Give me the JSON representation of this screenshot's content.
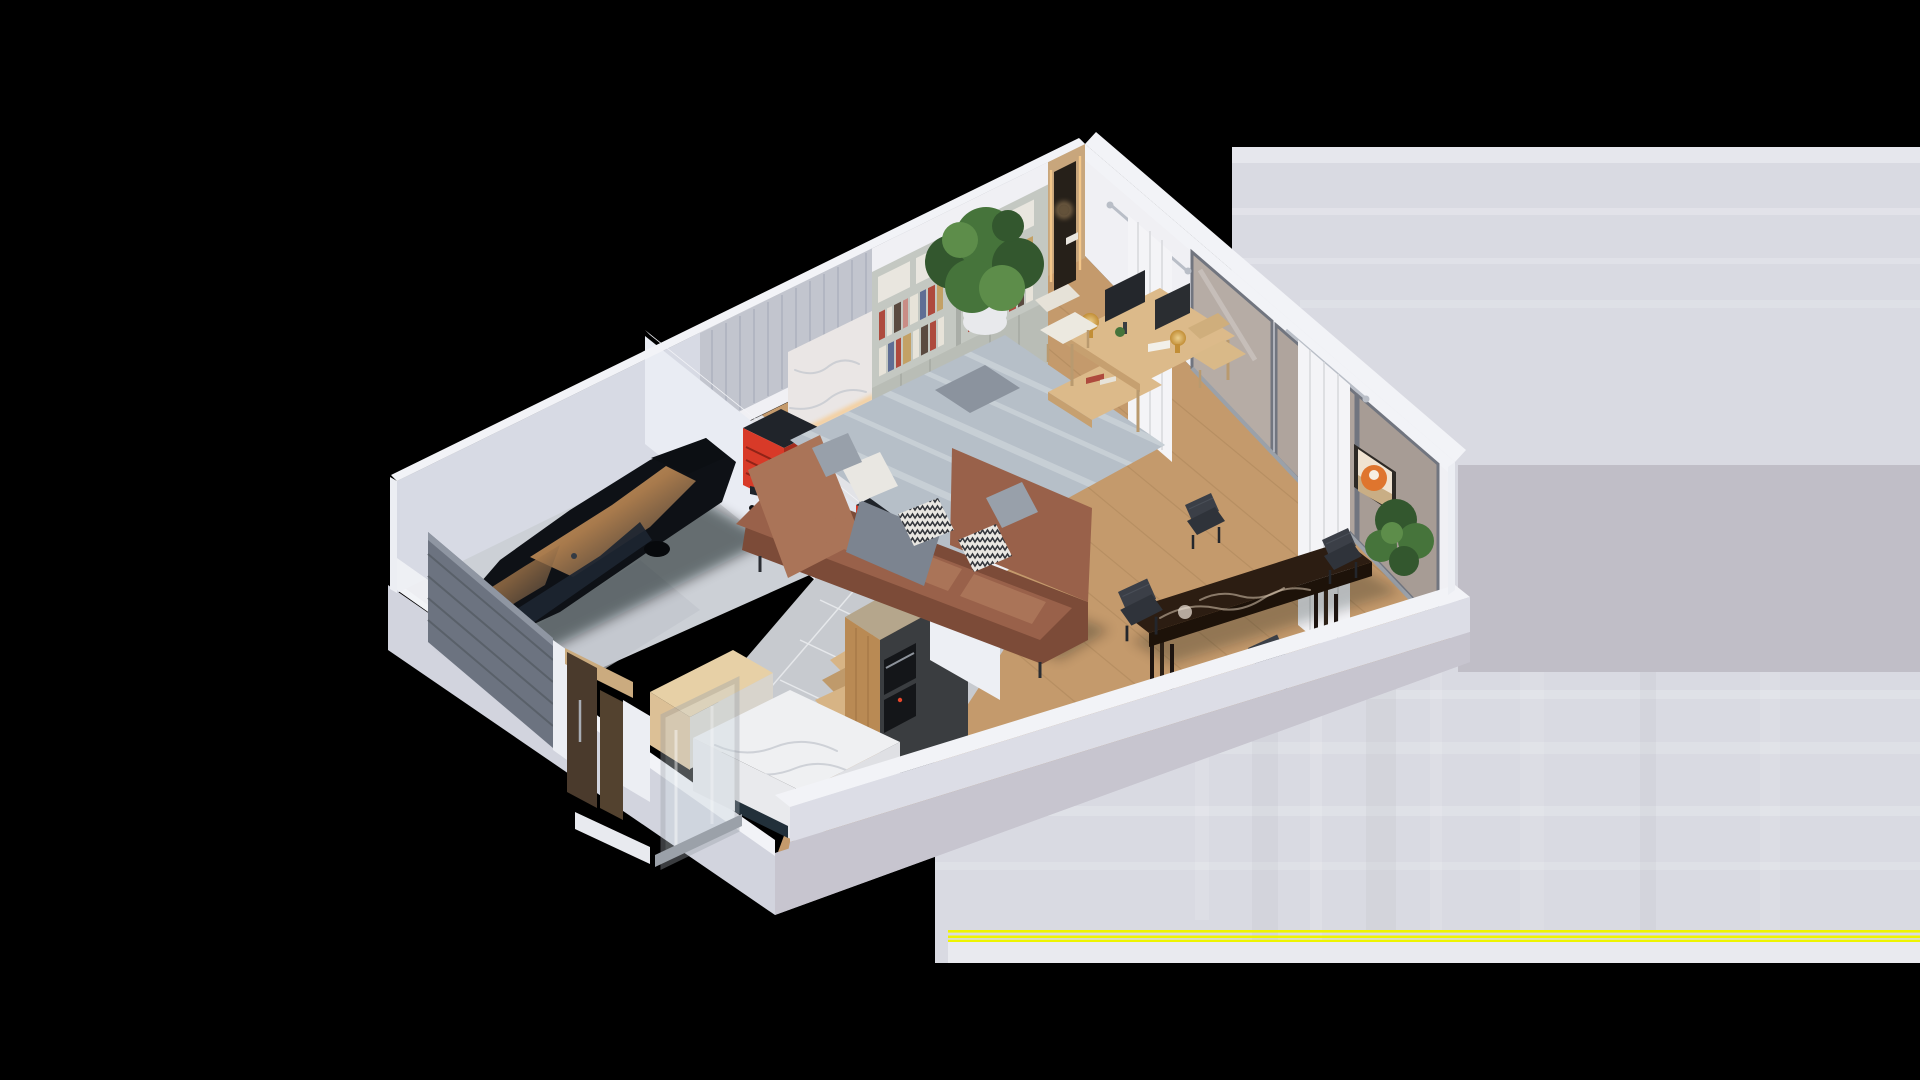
{
  "meta": {
    "description": "Isometric 3D cutaway floor-plan render of a one-storey home on a black background. Right side of the image is a corrupted/partially-loaded block: flat light gray with horizontal banding and yellow scanline artifacts.",
    "projection": "isometric cutaway, roof removed",
    "background": "black"
  },
  "artifact": {
    "kind": "corrupted-image-region",
    "area": "right side, y 147-963",
    "yellow_scanlines_y": [
      931,
      936,
      940
    ]
  },
  "rooms": [
    {
      "name": "garage",
      "features": [
        "black sports car",
        "gray slatted garage door (tilted open)",
        "red tool cabinet",
        "red tool cart"
      ]
    },
    {
      "name": "hallway",
      "features": [
        "marble feature wall",
        "warm LED cove lighting"
      ]
    },
    {
      "name": "living-room",
      "features": [
        "bookshelf wall with colorful books",
        "large potted plant",
        "wood desk with two monitors and gold lamps",
        "cream shell chair",
        "brown leather sectional sofa",
        "gray throw blanket",
        "chevron pillows",
        "blue-gray area rug",
        "wood coffee table",
        "sliding glass wall with taupe reflective panes",
        "white curtains on silver rods"
      ]
    },
    {
      "name": "dining-area",
      "features": [
        "dark brown marble dining table",
        "four charcoal quilted chairs",
        "orange abstract wall painting",
        "corner plant"
      ]
    },
    {
      "name": "kitchen",
      "features": [
        "tall oak cabinet with built-in ovens",
        "white marble island",
        "glass partition with silver frame",
        "light wood cabinet box",
        "gray tile floor",
        "wood staircase with winder steps"
      ]
    },
    {
      "name": "entry-porch",
      "features": [
        "dark walnut entry door",
        "walnut side panel",
        "light wood header beam",
        "white step"
      ]
    }
  ],
  "colors": {
    "bg": "#000000",
    "backdrop": "#d9dae2",
    "backdropLight": "#e7e8ee",
    "backdropDark": "#c0bec7",
    "backdropBottom": "#e9eaef",
    "artifactYellow": "#eef400",
    "wallTop": "#f2f3f7",
    "wallInnerLeft": "#d7dae4",
    "wallInnerRight": "#f0f0f4",
    "wallLavender": "#ccd0dd",
    "parapetFace": "#dcdde6",
    "slabLeft": "#d2d4de",
    "slabRight": "#c7c5cf",
    "capWhite": "#eceef3",
    "floorWood": "#c49a6c",
    "plankLine": "#8a6a42",
    "rug": "#b6bfc8",
    "rugLight": "#cdd4da",
    "garageFloor": "#ccd0d6",
    "hallMarble": "#e2e3e7",
    "kitchenTile": "#c7cacf",
    "grout": "#e9ebee",
    "partition": "#e9ecf3",
    "marblePanel": "#eae6e5",
    "slatPanel": "#c2c5ce",
    "woodPanel": "#c8a67c",
    "nookDark": "#262019",
    "ledWarm": "#f6c98b",
    "bookshelfBody": "#c4c8c2",
    "bookshelfDoors": "#b9bdb6",
    "boxWhite": "#e9e6df",
    "bookRed": "#ae4a3d",
    "bookWhite": "#e7e3d9",
    "bookBlue": "#5f6e94",
    "bookDark": "#5a4a40",
    "bookTan": "#c3a166",
    "bookPink": "#c98d86",
    "plantDark": "#33572e",
    "plantMid": "#46743b",
    "plantLight": "#5d8d4a",
    "potWhite": "#e8e9ec",
    "sofaBase": "#99614a",
    "sofaLight": "#aa7458",
    "sofaDark": "#7c4b38",
    "pillowGray": "#98a0aa",
    "pillowWhite": "#e9e7e2",
    "blanket": "#7c8490",
    "deskWood": "#dcba8a",
    "chairCream": "#ece9e0",
    "lampGold": "#c28e36",
    "monitorDark": "#24272c",
    "tableMarble": "#2c1d12",
    "tableVein": "#d8c6b0",
    "chairCharcoal": "#3b3f47",
    "stairWood": "#d7b485",
    "stairRiser": "#bf9a6b",
    "stairSide": "#eef0f4",
    "carBody": "#0e1116",
    "carGlassDark": "#1c2531",
    "bronze": "#a87a4c",
    "bronzeLight": "#cfa876",
    "carDetail": "#343b44",
    "redCab": "#d83a28",
    "redCabDark": "#a52c1d",
    "black": "#20242a",
    "garageDoor": "#6c7380",
    "garageDoorLine": "#596069",
    "oak": "#b98a54",
    "oakDark": "#8f6537",
    "counterTaupe": "#b5a68c",
    "kitchenDark": "#3a3d40",
    "marbleWhite": "#eff0f2",
    "veinGray": "#c5c9cf",
    "creamPanel": "#d8d4cc",
    "glass": "#ccd7de",
    "frameSilver": "#9ba1a9",
    "windowGlass1": "#b6aca5",
    "windowGlass2": "#afa49d",
    "windowGlass3": "#a79c95",
    "windowFrame": "#71757f",
    "curtain": "#f4f4f7",
    "curtainShade": "#d9dade",
    "paintOrange": "#df752e",
    "paintCream": "#f0e3d1",
    "paintSand": "#c9ae85",
    "frameDark": "#2d2925"
  }
}
